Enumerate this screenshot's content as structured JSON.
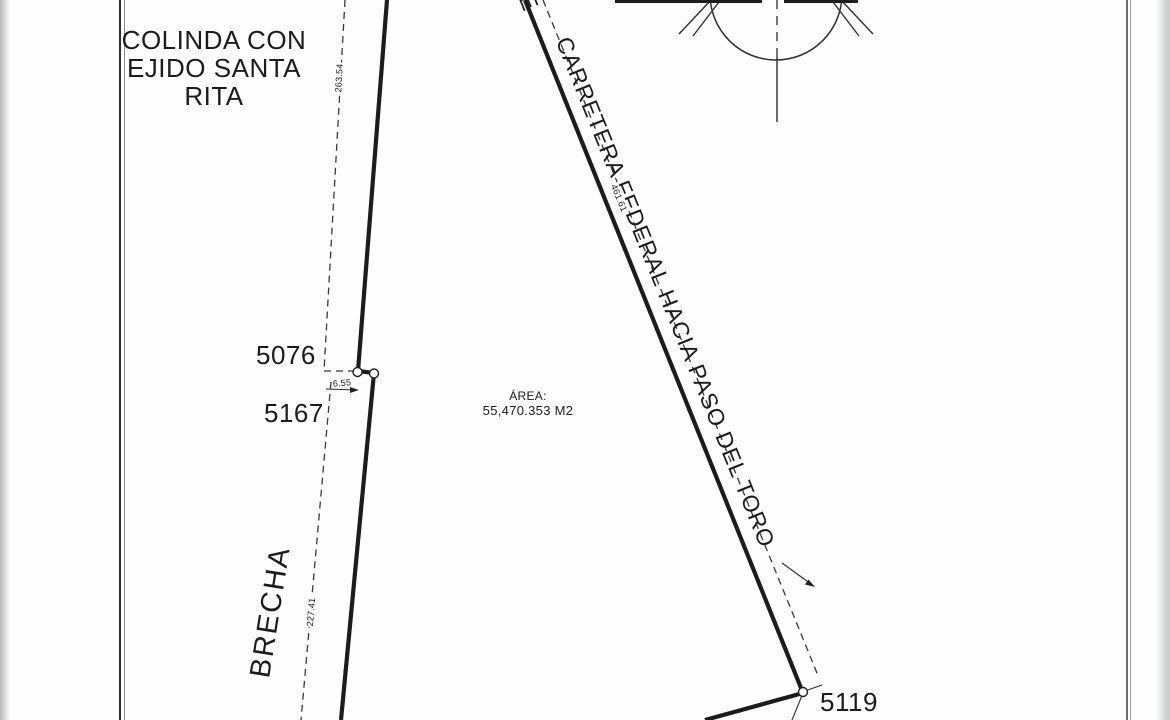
{
  "labels": {
    "neighbor_line1": "COLINDA CON",
    "neighbor_line2": "EJIDO SANTA RITA",
    "road": "CARRETERA FEDERAL  HACIA PASO DEL TORO",
    "road_cutoff_letter": "E",
    "path_label": "BRECHA",
    "area_title": "ÁREA:",
    "area_value": "55,470.353 M2"
  },
  "vertices": [
    {
      "id": "5076"
    },
    {
      "id": "5167"
    },
    {
      "id": "5119"
    }
  ],
  "dimensions": {
    "west_upper": "263.54",
    "west_jog": "6.55",
    "west_lower": "227.41",
    "road_frontage": "461.61"
  },
  "icons": {
    "north_arrow": "north-arrow"
  },
  "colors": {
    "ink": "#1c1c1c",
    "paper": "#fefefe",
    "frame-dark": "#2e2e2e",
    "frame-gray": "#8a8a8a"
  }
}
